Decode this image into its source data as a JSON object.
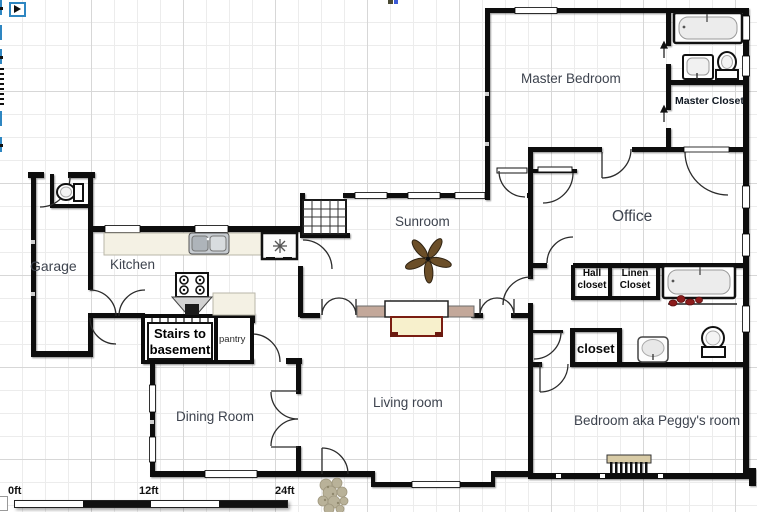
{
  "app": {
    "type": "floor-plan-editor-canvas",
    "toolbar_icons": [
      "play-icon",
      "partial-button",
      "partial-button",
      "partial-button",
      "ruler-ticks",
      "partial-button",
      "partial-button"
    ]
  },
  "rooms": {
    "master_bedroom": "Master Bedroom",
    "master_closet": "Master Closet",
    "office": "Office",
    "sunroom": "Sunroom",
    "garage": "Garage",
    "kitchen": "Kitchen",
    "stairs_line1": "Stairs to",
    "stairs_line2": "basement",
    "pantry": "pantry",
    "dining_room": "Dining Room",
    "living_room": "Living room",
    "hall_closet_line1": "Hall",
    "hall_closet_line2": "closet",
    "linen_closet_line1": "Linen",
    "linen_closet_line2": "Closet",
    "closet": "closet",
    "peggys_room": "Bedroom aka Peggy's room"
  },
  "scale": {
    "t0": "0ft",
    "t1": "12ft",
    "t2": "24ft"
  },
  "fixtures": [
    "bathtub-master",
    "sink-master",
    "toilet-master",
    "closet-door-arrows",
    "bathtub-hall",
    "towel-rack",
    "sink-hall",
    "toilet-hall",
    "toilet-garage",
    "kitchen-counter",
    "kitchen-sink",
    "fridge-snowflake",
    "stove-burners",
    "range-hood",
    "stairs-up",
    "stairs-basement",
    "fireplace",
    "window-sills",
    "ceiling-fan",
    "radiator",
    "shrubs"
  ],
  "colors": {
    "wall": "#0c0c0c",
    "accent_blue": "#2e86c1",
    "label_text": "#3d434e",
    "hearth": "#f7f0cc",
    "hearth_border": "#7a1d12",
    "sill": "#c3a89a",
    "fan_blade": "#6b4e28",
    "towel_red": "#8c1c1c",
    "plant": "#b6ae94",
    "counter": "#f4f1e4",
    "radiator_top": "#d8cba6"
  }
}
